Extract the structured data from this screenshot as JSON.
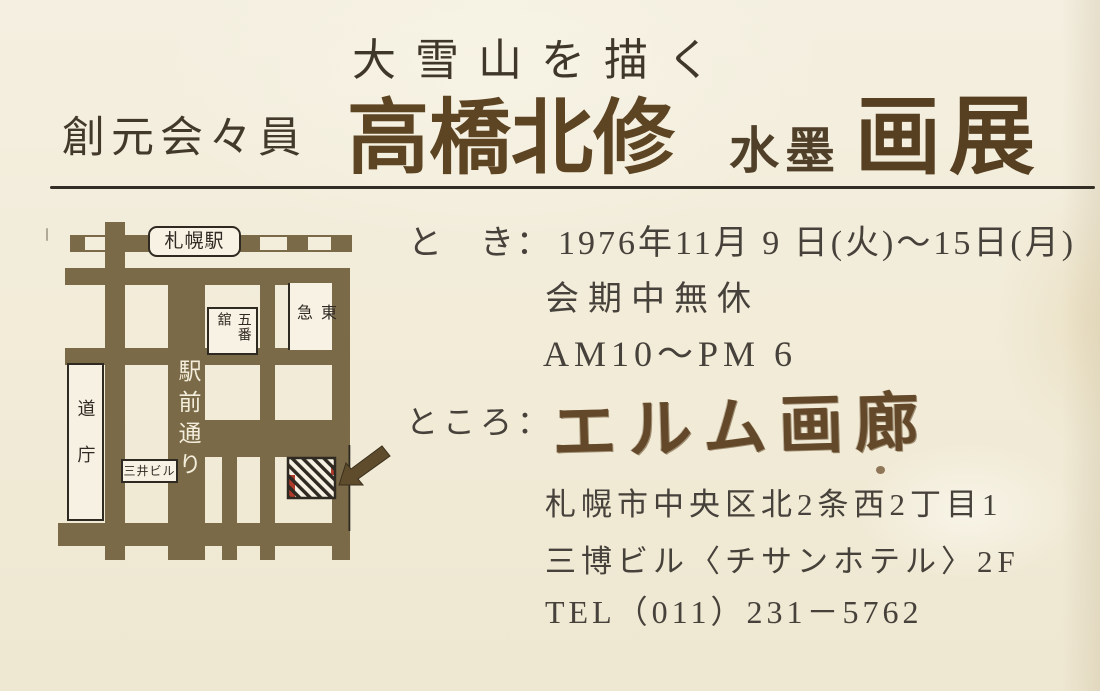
{
  "header": {
    "subtitle": "大雪山を描く",
    "affiliation": "創元会々員",
    "artist": "高橋北修",
    "medium": "水墨",
    "show_type": "画展"
  },
  "schedule": {
    "label": "と　き：",
    "dates": "1976年11月 9 日(火)～15日(月)",
    "closed_note": "会期中無休",
    "hours": "AM10～PM 6"
  },
  "venue": {
    "label": "ところ：",
    "gallery": "エルム画廊",
    "address_line1": "札幌市中央区北2条西2丁目1",
    "address_line2": "三博ビル〈チサンホテル〉2F",
    "phone": "TEL（011）231－5762"
  },
  "map": {
    "station": "札幌駅",
    "street": "駅前通り",
    "department_store": "五番舘",
    "tokyu_store": "東急",
    "pref_office": "道庁",
    "mitsui_building": "三井ビル",
    "colors": {
      "road": "#7b6a47",
      "ink": "#2e2a22",
      "marker_red": "#b03a2a",
      "paper": "#f3eedc"
    }
  },
  "colors": {
    "background": "#f1ebd8",
    "title_ink": "#5d4423",
    "heading_ink": "#42392b",
    "body_ink": "#46413a",
    "calligraphy_ink": "#63482a",
    "divider": "#322d25"
  }
}
